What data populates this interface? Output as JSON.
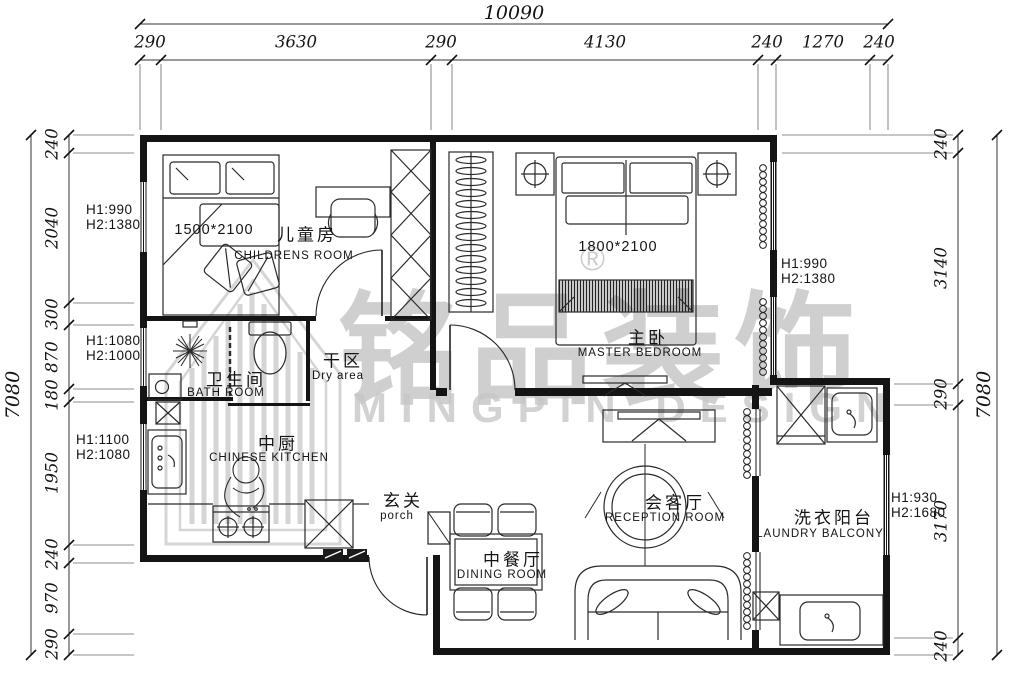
{
  "watermark": {
    "zh": "铭品装饰",
    "en": "MINGPIN DESIGN",
    "registered": "®"
  },
  "dim_top": {
    "total": "10090",
    "segs": [
      "290",
      "3630",
      "290",
      "4130",
      "240",
      "1270",
      "240"
    ]
  },
  "dim_left": {
    "total": "7080",
    "segs": [
      "240",
      "2040",
      "300",
      "870",
      "180",
      "1950",
      "240",
      "970",
      "290"
    ]
  },
  "dim_right": {
    "total": "7080",
    "segs": [
      "240",
      "3140",
      "290",
      "3170",
      "240"
    ]
  },
  "window_notes": [
    {
      "l1": "H1:990",
      "l2": "H2:1380"
    },
    {
      "l1": "H1:1080",
      "l2": "H2:1000"
    },
    {
      "l1": "H1:1100",
      "l2": "H2:1080"
    },
    {
      "l1": "H1:990",
      "l2": "H2:1380"
    },
    {
      "l1": "H1:930",
      "l2": "H2:1680"
    }
  ],
  "rooms": {
    "childrens": {
      "zh": "儿童房",
      "en": "CHILDRENS ROOM",
      "bed": "1500*2100"
    },
    "master": {
      "zh": "主卧",
      "en": "MASTER BEDROOM",
      "bed": "1800*2100"
    },
    "bath": {
      "zh": "卫生间",
      "en": "BATH ROOM"
    },
    "dry": {
      "zh": "干区",
      "en": "Dry area"
    },
    "kitchen": {
      "zh": "中厨",
      "en": "CHINESE KITCHEN"
    },
    "porch": {
      "zh": "玄关",
      "en": "porch"
    },
    "dining": {
      "zh": "中餐厅",
      "en": "DINING ROOM"
    },
    "reception": {
      "zh": "会客厅",
      "en": "RECEPTION ROOM"
    },
    "laundry": {
      "zh": "洗衣阳台",
      "en": "LAUNDRY BALCONY"
    }
  },
  "colors": {
    "line": "#141414",
    "watermark": "#c7c7c7",
    "paper": "#ffffff"
  }
}
